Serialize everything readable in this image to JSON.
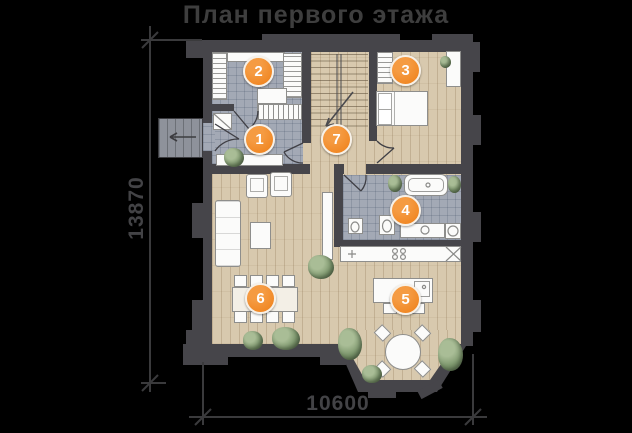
{
  "title": "План первого этажа",
  "dimension_labels": {
    "left_vertical": "13870",
    "bottom_horizontal": "10600"
  },
  "room_markers": [
    {
      "number": "1"
    },
    {
      "number": "2"
    },
    {
      "number": "3"
    },
    {
      "number": "4"
    },
    {
      "number": "5"
    },
    {
      "number": "6"
    },
    {
      "number": "7"
    }
  ],
  "colors": {
    "marker_orange": "#ee7e16",
    "wall_gray": "#46454a",
    "tile_floor": "#a3a9b5",
    "wood_floor": "#d8c9ae",
    "background": "#000000",
    "annotation_gray": "#3e3e40"
  }
}
